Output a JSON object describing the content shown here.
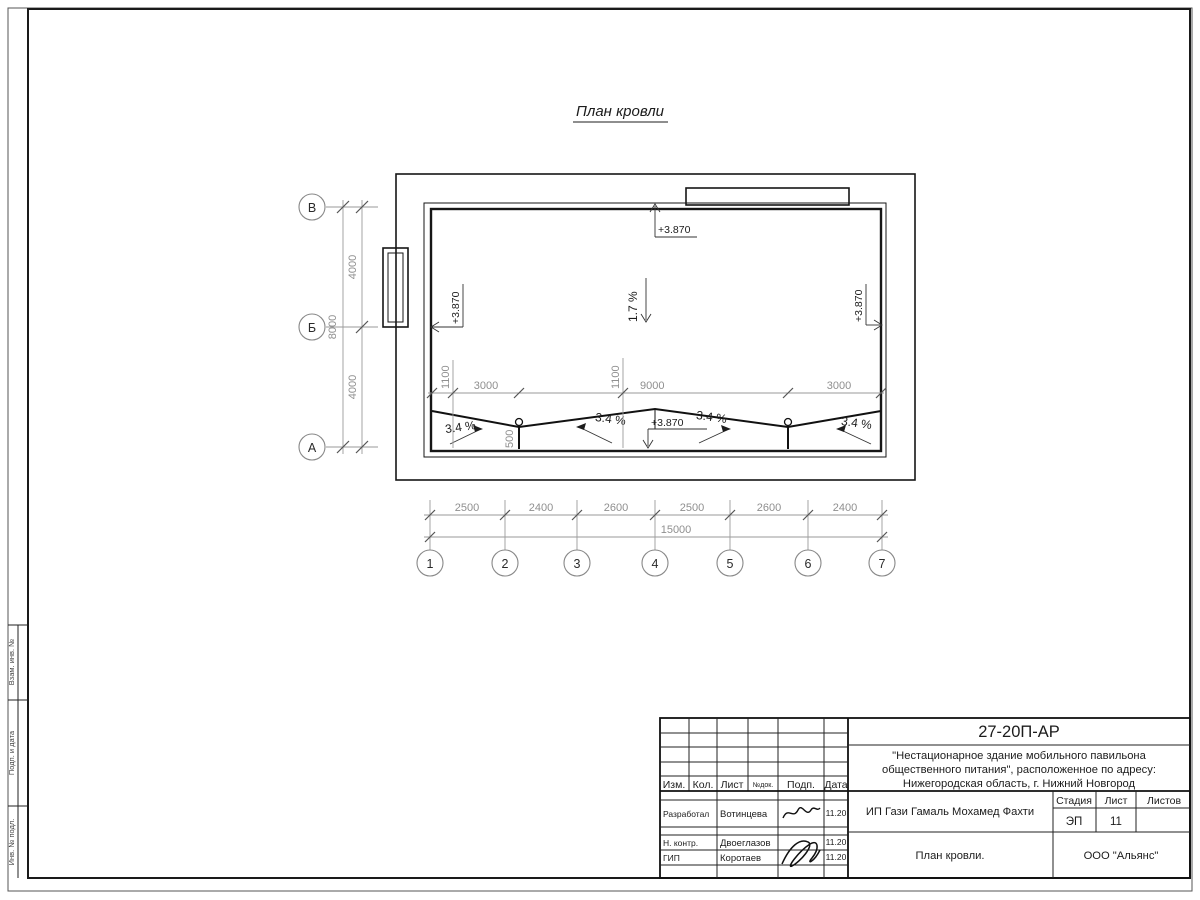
{
  "title": "План кровли",
  "axes": {
    "rows": [
      "В",
      "Б",
      "А"
    ],
    "cols": [
      "1",
      "2",
      "3",
      "4",
      "5",
      "6",
      "7"
    ]
  },
  "dims": {
    "row_spacing": [
      "4000",
      "4000"
    ],
    "row_total": "8000",
    "col_spacing": [
      "2500",
      "2400",
      "2600",
      "2500",
      "2600",
      "2400"
    ],
    "col_total": "15000",
    "roof_offsets": [
      "1100",
      "3000",
      "1100",
      "9000",
      "3000"
    ],
    "drain_depth": "500"
  },
  "annotations": {
    "elevation": "+3.870",
    "main_slope": "1.7 %",
    "valley_slope": "3.4 %"
  },
  "frame": {
    "side_labels": [
      "Взам. инв. №",
      "Подп. и дата",
      "Инв. № подл."
    ]
  },
  "titleblock": {
    "doc_number": "27-20П-АР",
    "project_line1": "\"Нестационарное здание мобильного павильона",
    "project_line2": "общественного питания\", расположенное по адресу:",
    "project_line3": "Нижегородская область, г. Нижний Новгород",
    "header": {
      "izm": "Изм.",
      "kol": "Кол.",
      "list": "Лист",
      "ndok": "№док.",
      "podp": "Подп.",
      "data": "Дата"
    },
    "stage_label": "Стадия",
    "sheet_label": "Лист",
    "sheets_label": "Листов",
    "stage": "ЭП",
    "sheet": "11",
    "client": "ИП Гази Гамаль Мохамед Фахти",
    "sheet_title": "План кровли.",
    "company": "ООО \"Альянс\"",
    "rows": [
      {
        "role": "Разработал",
        "name": "Вотинцева",
        "date": "11.20"
      },
      {
        "role": "Н. контр.",
        "name": "Двоеглазов",
        "date": "11.20"
      },
      {
        "role": "ГИП",
        "name": "Коротаев",
        "date": "11.20"
      }
    ]
  }
}
